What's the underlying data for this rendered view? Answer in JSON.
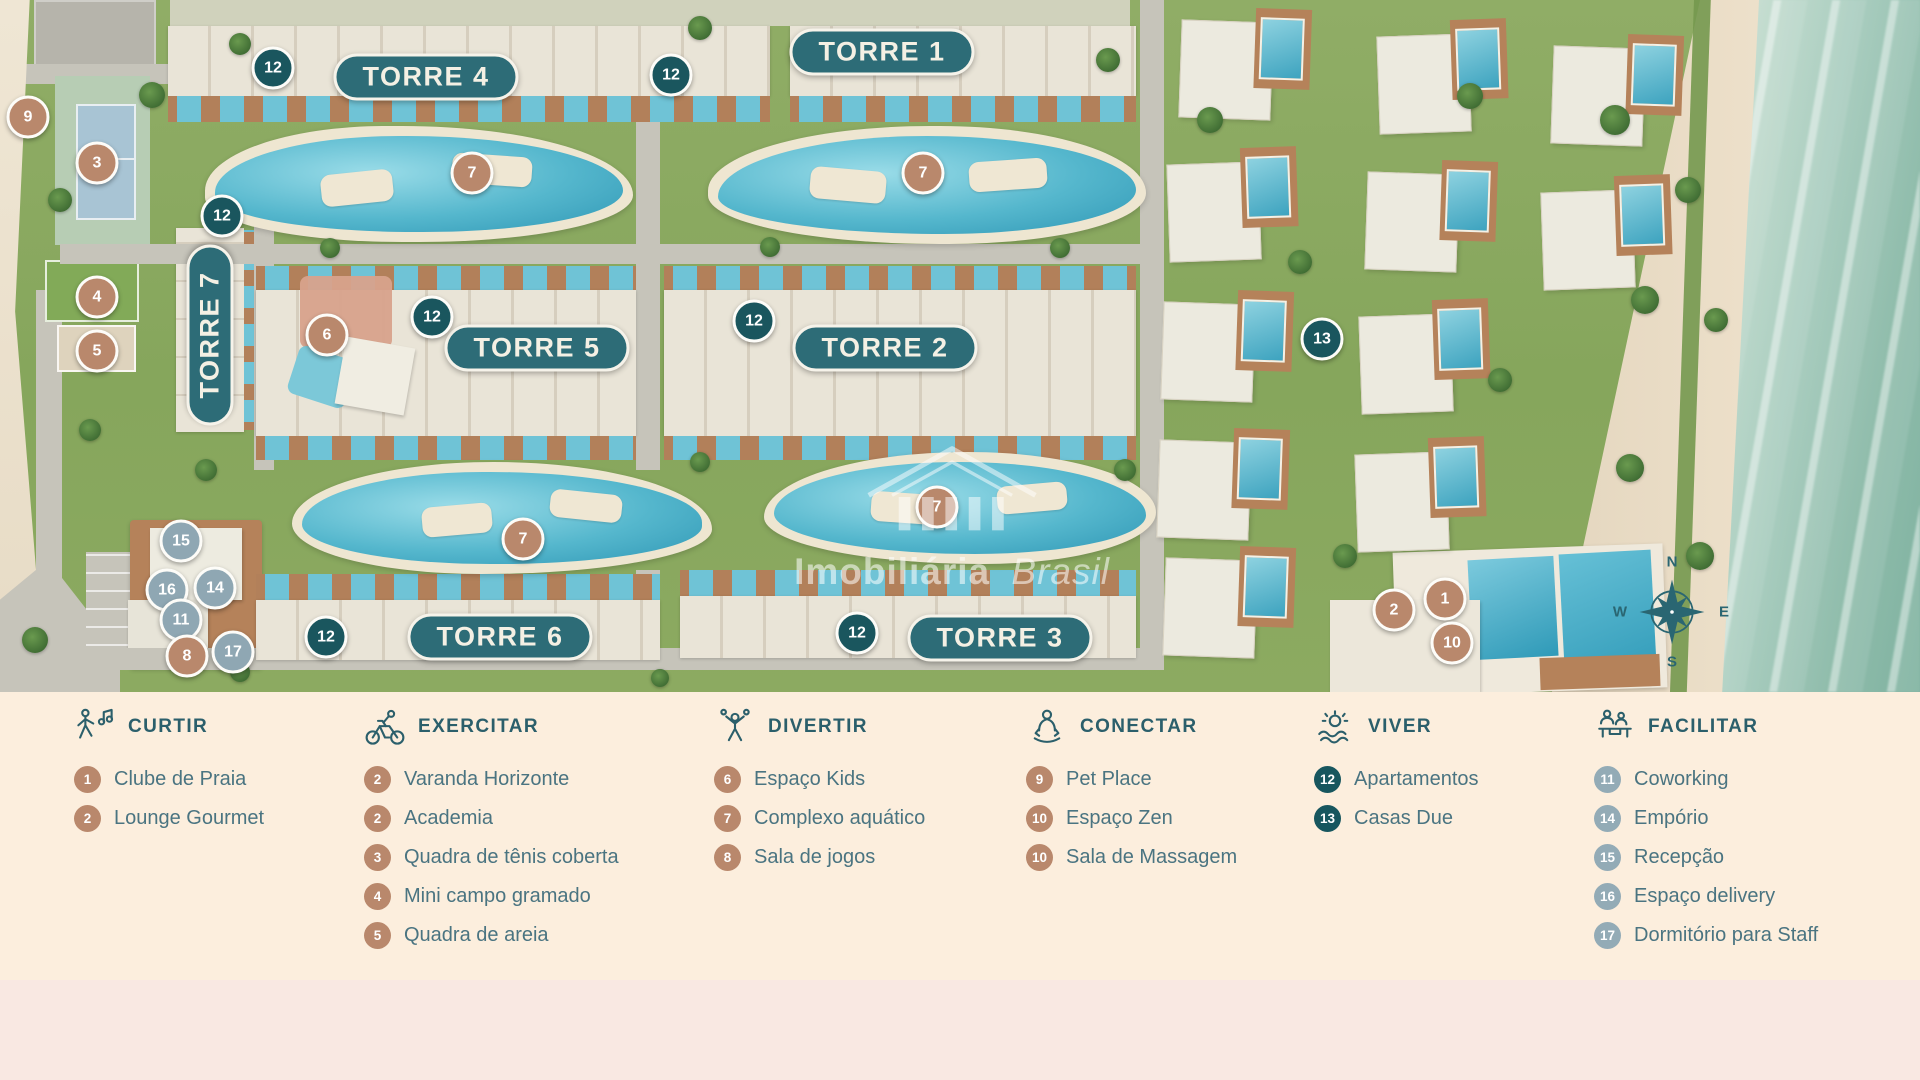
{
  "map": {
    "watermark": {
      "word1": "Imobiliária",
      "word2": "Brasil"
    },
    "compass": {
      "n": "N",
      "e": "E",
      "s": "S",
      "w": "W"
    },
    "towers": [
      {
        "label": "TORRE 1",
        "x": 882,
        "y": 52,
        "orientation": "h"
      },
      {
        "label": "TORRE 4",
        "x": 426,
        "y": 77,
        "orientation": "h"
      },
      {
        "label": "TORRE 7",
        "x": 210,
        "y": 335,
        "orientation": "v"
      },
      {
        "label": "TORRE 5",
        "x": 537,
        "y": 348,
        "orientation": "h"
      },
      {
        "label": "TORRE 2",
        "x": 885,
        "y": 348,
        "orientation": "h"
      },
      {
        "label": "TORRE 6",
        "x": 500,
        "y": 637,
        "orientation": "h"
      },
      {
        "label": "TORRE 3",
        "x": 1000,
        "y": 638,
        "orientation": "h"
      }
    ],
    "markers": [
      {
        "label": "9",
        "type": "brown",
        "x": 28,
        "y": 117
      },
      {
        "label": "3",
        "type": "brown",
        "x": 97,
        "y": 163
      },
      {
        "label": "4",
        "type": "brown",
        "x": 97,
        "y": 297
      },
      {
        "label": "5",
        "type": "brown",
        "x": 97,
        "y": 351
      },
      {
        "label": "12",
        "type": "teal",
        "x": 273,
        "y": 68
      },
      {
        "label": "12",
        "type": "teal",
        "x": 671,
        "y": 75
      },
      {
        "label": "12",
        "type": "teal",
        "x": 222,
        "y": 216
      },
      {
        "label": "7",
        "type": "brown",
        "x": 472,
        "y": 173
      },
      {
        "label": "7",
        "type": "brown",
        "x": 923,
        "y": 173
      },
      {
        "label": "6",
        "type": "brown",
        "x": 327,
        "y": 335
      },
      {
        "label": "12",
        "type": "teal",
        "x": 432,
        "y": 317
      },
      {
        "label": "12",
        "type": "teal",
        "x": 754,
        "y": 321
      },
      {
        "label": "13",
        "type": "teal",
        "x": 1322,
        "y": 339
      },
      {
        "label": "7",
        "type": "brown",
        "x": 523,
        "y": 539
      },
      {
        "label": "7",
        "type": "brown",
        "x": 937,
        "y": 507
      },
      {
        "label": "15",
        "type": "gray",
        "x": 181,
        "y": 541
      },
      {
        "label": "16",
        "type": "gray",
        "x": 167,
        "y": 590
      },
      {
        "label": "14",
        "type": "gray",
        "x": 215,
        "y": 588
      },
      {
        "label": "11",
        "type": "gray",
        "x": 181,
        "y": 620
      },
      {
        "label": "8",
        "type": "brown",
        "x": 187,
        "y": 656
      },
      {
        "label": "17",
        "type": "gray",
        "x": 233,
        "y": 652
      },
      {
        "label": "12",
        "type": "teal",
        "x": 326,
        "y": 637
      },
      {
        "label": "12",
        "type": "teal",
        "x": 857,
        "y": 633
      },
      {
        "label": "2",
        "type": "brown",
        "x": 1394,
        "y": 610
      },
      {
        "label": "1",
        "type": "brown",
        "x": 1445,
        "y": 599
      },
      {
        "label": "10",
        "type": "brown",
        "x": 1452,
        "y": 643
      }
    ]
  },
  "legend": {
    "sections": [
      {
        "title": "CURTIR",
        "icon": "dancing-person-icon",
        "items": [
          {
            "num": "1",
            "color": "brown",
            "label": "Clube de Praia"
          },
          {
            "num": "2",
            "color": "brown",
            "label": "Lounge Gourmet"
          }
        ]
      },
      {
        "title": "EXERCITAR",
        "icon": "cyclist-icon",
        "items": [
          {
            "num": "2",
            "color": "brown",
            "label": "Varanda Horizonte"
          },
          {
            "num": "2",
            "color": "brown",
            "label": "Academia"
          },
          {
            "num": "3",
            "color": "brown",
            "label": "Quadra de tênis coberta"
          },
          {
            "num": "4",
            "color": "brown",
            "label": "Mini campo gramado"
          },
          {
            "num": "5",
            "color": "brown",
            "label": "Quadra de areia"
          }
        ]
      },
      {
        "title": "DIVERTIR",
        "icon": "juggler-icon",
        "items": [
          {
            "num": "6",
            "color": "brown",
            "label": "Espaço Kids"
          },
          {
            "num": "7",
            "color": "brown",
            "label": "Complexo aquático"
          },
          {
            "num": "8",
            "color": "brown",
            "label": "Sala de jogos"
          }
        ]
      },
      {
        "title": "CONECTAR",
        "icon": "meditation-icon",
        "items": [
          {
            "num": "9",
            "color": "brown",
            "label": "Pet Place"
          },
          {
            "num": "10",
            "color": "brown",
            "label": "Espaço Zen"
          },
          {
            "num": "10",
            "color": "brown",
            "label": "Sala de Massagem"
          }
        ]
      },
      {
        "title": "VIVER",
        "icon": "sun-waves-icon",
        "items": [
          {
            "num": "12",
            "color": "teal",
            "label": "Apartamentos"
          },
          {
            "num": "13",
            "color": "teal",
            "label": "Casas Due"
          }
        ]
      },
      {
        "title": "FACILITAR",
        "icon": "concierge-icon",
        "items": [
          {
            "num": "11",
            "color": "gray",
            "label": "Coworking"
          },
          {
            "num": "14",
            "color": "gray",
            "label": "Empório"
          },
          {
            "num": "15",
            "color": "gray",
            "label": "Recepção"
          },
          {
            "num": "16",
            "color": "gray",
            "label": "Espaço delivery"
          },
          {
            "num": "17",
            "color": "gray",
            "label": "Dormitório para Staff"
          }
        ]
      }
    ]
  },
  "colors": {
    "badge_brown": "#b9886c",
    "badge_teal": "#17565e",
    "badge_gray": "#93abb6",
    "tower_pill": "#2d6c77",
    "legend_heading": "#2b5f6b",
    "legend_text": "#4a7481",
    "legend_bg": "#fceedd",
    "footer_bg": "#f9e8e2",
    "pool_blue": "#6fc3d6",
    "ocean_green": "#8fbcab",
    "grass_green": "#8ca85f"
  }
}
